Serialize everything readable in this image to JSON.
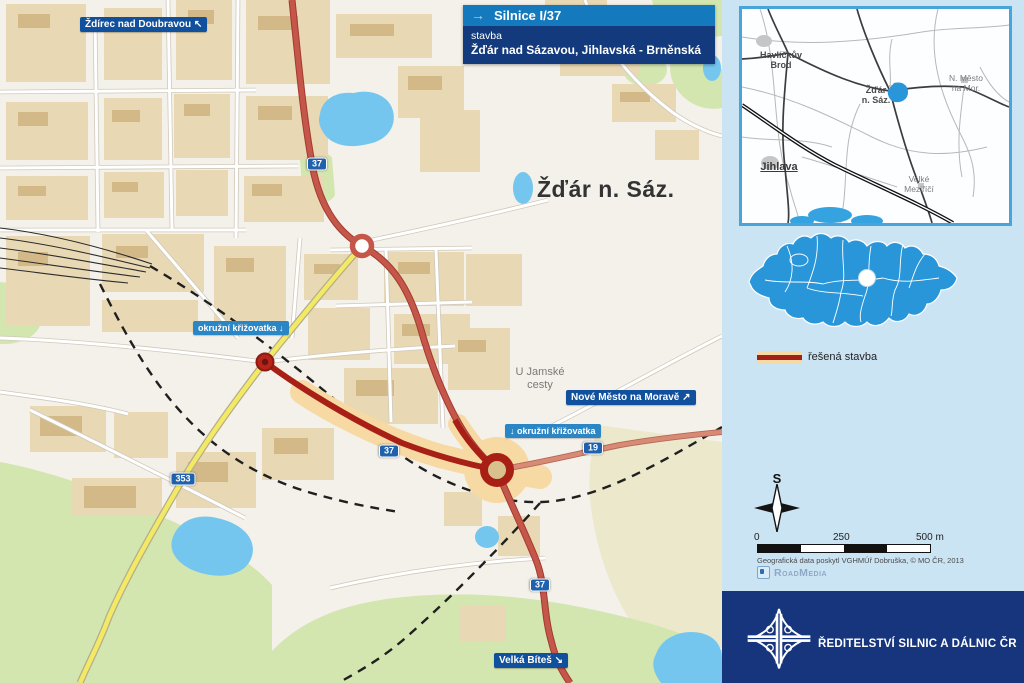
{
  "colors": {
    "accent_blue": "#1479bd",
    "navy": "#123a7c",
    "direction_label_blue": "#11509c",
    "info_label_blue": "#2b86c6",
    "badge_blue": "#1f61ac",
    "existing_road_red": "#c4564a",
    "construction_red": "#a81f16",
    "buffer_orange": "#f7d9a4",
    "region_blue": "#2996da",
    "footer_navy": "#16357d",
    "water_blue": "#74c6ee"
  },
  "title_box": {
    "arrow": "→",
    "route": "Silnice I/37",
    "type": "stavba",
    "name": "Žďár nad Sázavou, Jihlavská - Brněnská"
  },
  "map": {
    "city_label": "Žďár n. Sáz.",
    "area_label": "U Jamské\ncesty",
    "dir_zdirec": "Ždírec nad Doubravou ↖",
    "dir_nove_mesto": "Nové Město na Moravě ↗",
    "dir_velka_bites": "Velká Bíteš ↘",
    "roundabout_label_1": "okružní křižovatka ↓",
    "roundabout_label_2": "↓ okružní křižovatka",
    "badge_37": "37",
    "badge_19": "19",
    "badge_353": "353"
  },
  "overview": {
    "havlickuv_brod": "Havlíčkův\nBrod",
    "zdar": "Žďár\nn. Sáz.",
    "nove_mesto": "N. Město\nna Mor.",
    "jihlava": "Jihlava",
    "velke_mezirici": "Velké\nMeziříčí"
  },
  "legend": {
    "resena_stavba": "řešená stavba"
  },
  "compass": {
    "north": "S"
  },
  "scalebar": {
    "start": "0",
    "middle": "250",
    "end": "500 m"
  },
  "credits": {
    "geodata": "Geografická data poskytl VGHMÚř Dobruška, © MO ČR, 2013",
    "brand": "RoadMedia"
  },
  "footer": {
    "org": "ŘEDITELSTVÍ SILNIC A DÁLNIC ČR"
  }
}
